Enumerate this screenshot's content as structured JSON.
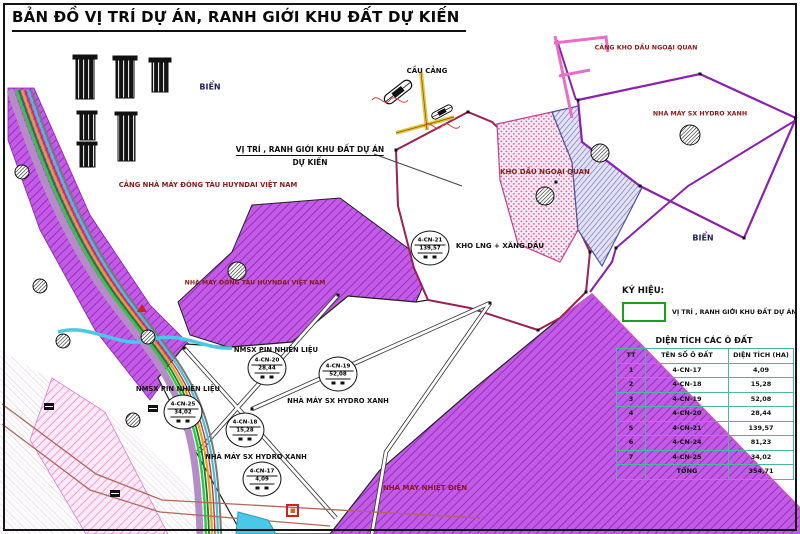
{
  "page": {
    "title": "BẢN ĐỒ VỊ TRÍ DỰ ÁN, RANH GIỚI KHU ĐẤT DỰ KIẾN"
  },
  "colors": {
    "boundary_purple": "#8a20b0",
    "parcel_boundary_red": "#9c2050",
    "industrial_purple_fill": "#c25ce4",
    "table_grid_teal": "#49b89e",
    "legend_green": "#1e9e1e",
    "label_dark_red": "#8b1a1a",
    "sea_label_navy": "#21215e",
    "jetty_yellow": "#e6c23c",
    "pier_pink": "#ea6ec6"
  },
  "callout": {
    "line1": "VỊ TRÍ , RANH GIỚI KHU ĐẤT DỰ ÁN",
    "line2": "DỰ KIẾN"
  },
  "labels": [
    {
      "text": "CẦU CẢNG"
    },
    {
      "text": "CẢNG KHO DẦU NGOẠI QUAN"
    },
    {
      "text": "NHÀ MÁY SX HYDRO XANH"
    },
    {
      "text": "KHO DẦU NGOẠI QUAN"
    },
    {
      "text": "BIỂN"
    },
    {
      "text": "BIỂN"
    },
    {
      "text": "CẢNG NHÀ MÁY ĐÓNG TÀU HUYNDAI VIỆT NAM"
    },
    {
      "text": "NHÀ MÁY ĐÓNG TÀU HUYNDAI VIỆT NAM"
    },
    {
      "text": "KHO LNG + XĂNG DẦU"
    },
    {
      "text": "NMSX PIN NHIÊN LIỆU"
    },
    {
      "text": "NMSX PIN NHIÊN LIỆU"
    },
    {
      "text": "NHÀ MÁY SX HYDRO XANH"
    },
    {
      "text": "NHÀ MÁY SX HYDRO XANH"
    },
    {
      "text": "NHÀ MÁY NHIỆT ĐIỆN"
    }
  ],
  "plots": [
    {
      "code": "4-CN-21",
      "area": "139,57"
    },
    {
      "code": "4-CN-20",
      "area": "28,44"
    },
    {
      "code": "4-CN-25",
      "area": "34,02"
    },
    {
      "code": "4-CN-19",
      "area": "52,08"
    },
    {
      "code": "4-CN-18",
      "area": "15,28"
    },
    {
      "code": "4-CN-17",
      "area": "4,09"
    }
  ],
  "legend": {
    "heading": "KÝ HIỆU:",
    "item": "VỊ TRÍ , RANH GIỚI KHU ĐẤT DỰ ÁN"
  },
  "table": {
    "title": "DIỆN TÍCH CÁC Ô ĐẤT",
    "headers": [
      "TT",
      "TÊN SỐ Ô ĐẤT",
      "DIỆN TÍCH (HA)"
    ],
    "rows": [
      [
        "1",
        "4-CN-17",
        "4,09"
      ],
      [
        "2",
        "4-CN-18",
        "15,28"
      ],
      [
        "3",
        "4-CN-19",
        "52,08"
      ],
      [
        "4",
        "4-CN-20",
        "28,44"
      ],
      [
        "5",
        "4-CN-21",
        "139,57"
      ],
      [
        "6",
        "4-CN-24",
        "81,23"
      ],
      [
        "7",
        "4-CN-25",
        "34,02"
      ]
    ],
    "total_label": "TỔNG",
    "total_value": "354,71"
  }
}
